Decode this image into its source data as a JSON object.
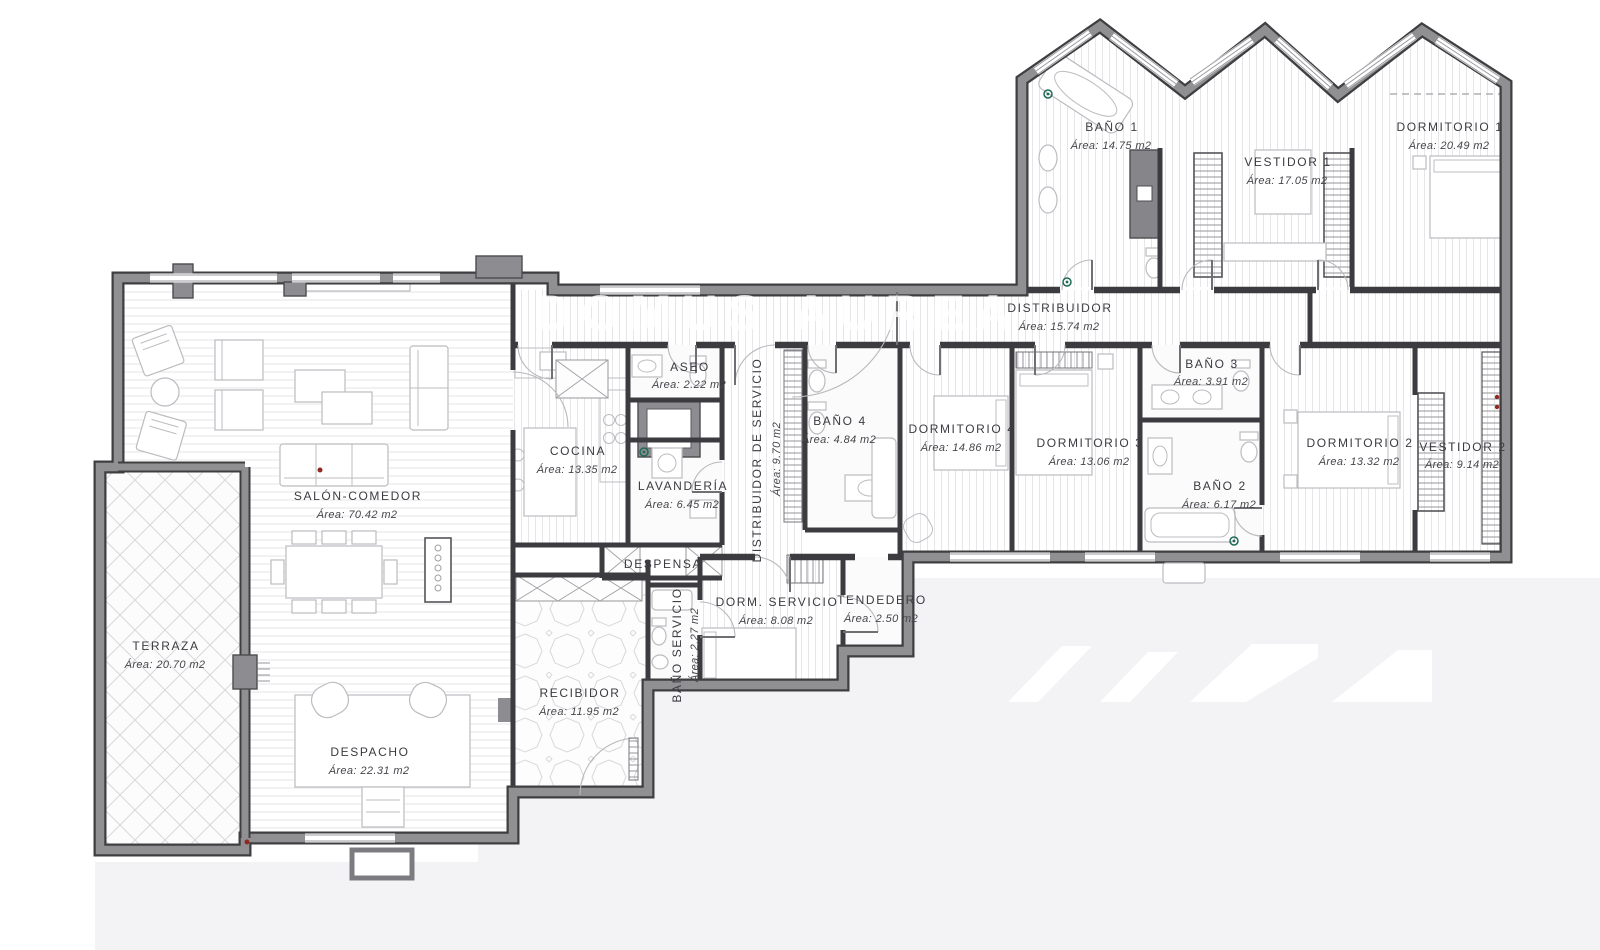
{
  "watermark": {
    "text": "DOMUS AUREA"
  },
  "rooms": [
    {
      "name": "TERRAZA",
      "area": "Área: 20.70 m2"
    },
    {
      "name": "SALÓN-COMEDOR",
      "area": "Área: 70.42 m2"
    },
    {
      "name": "DESPACHO",
      "area": "Área: 22.31 m2"
    },
    {
      "name": "COCINA",
      "area": "Área: 13.35 m2"
    },
    {
      "name": "ASEO",
      "area": "Área: 2.22 m2"
    },
    {
      "name": "LAVANDERÍA",
      "area": "Área: 6.45 m2"
    },
    {
      "name": "DESPENSA",
      "area": ""
    },
    {
      "name": "DISTRIBUIDOR DE SERVICIO",
      "area": "Área: 9.70 m2"
    },
    {
      "name": "RECIBIDOR",
      "area": "Área: 11.95 m2"
    },
    {
      "name": "BAÑO SERVICIO",
      "area": "Área: 2.27 m2"
    },
    {
      "name": "DORM. SERVICIO",
      "area": "Área: 8.08 m2"
    },
    {
      "name": "TENDEDERO",
      "area": "Área: 2.50 m2"
    },
    {
      "name": "DISTRIBUIDOR",
      "area": "Área: 15.74 m2"
    },
    {
      "name": "BAÑO 4",
      "area": "Área: 4.84 m2"
    },
    {
      "name": "DORMITORIO 4",
      "area": "Área: 14.86 m2"
    },
    {
      "name": "DORMITORIO 3",
      "area": "Área: 13.06 m2"
    },
    {
      "name": "BAÑO 3",
      "area": "Área: 3.91 m2"
    },
    {
      "name": "BAÑO 2",
      "area": "Área: 6.17 m2"
    },
    {
      "name": "DORMITORIO 2",
      "area": "Área: 13.32 m2"
    },
    {
      "name": "VESTIDOR 2",
      "area": "Área: 9.14 m2"
    },
    {
      "name": "BAÑO 1",
      "area": "Área: 14.75 m2"
    },
    {
      "name": "VESTIDOR 1",
      "area": "Área: 17.05 m2"
    },
    {
      "name": "DORMITORIO 1",
      "area": "Área: 20.49 m2"
    }
  ],
  "colors": {
    "wall_gray": "#909093",
    "wall_edge": "#3f3f42",
    "partition": "#3c3c40",
    "label_text": "#3b3b41",
    "background_gray": "#f3f3f5",
    "green_marker": "#1d6b55",
    "red_marker": "#8e2a22"
  }
}
